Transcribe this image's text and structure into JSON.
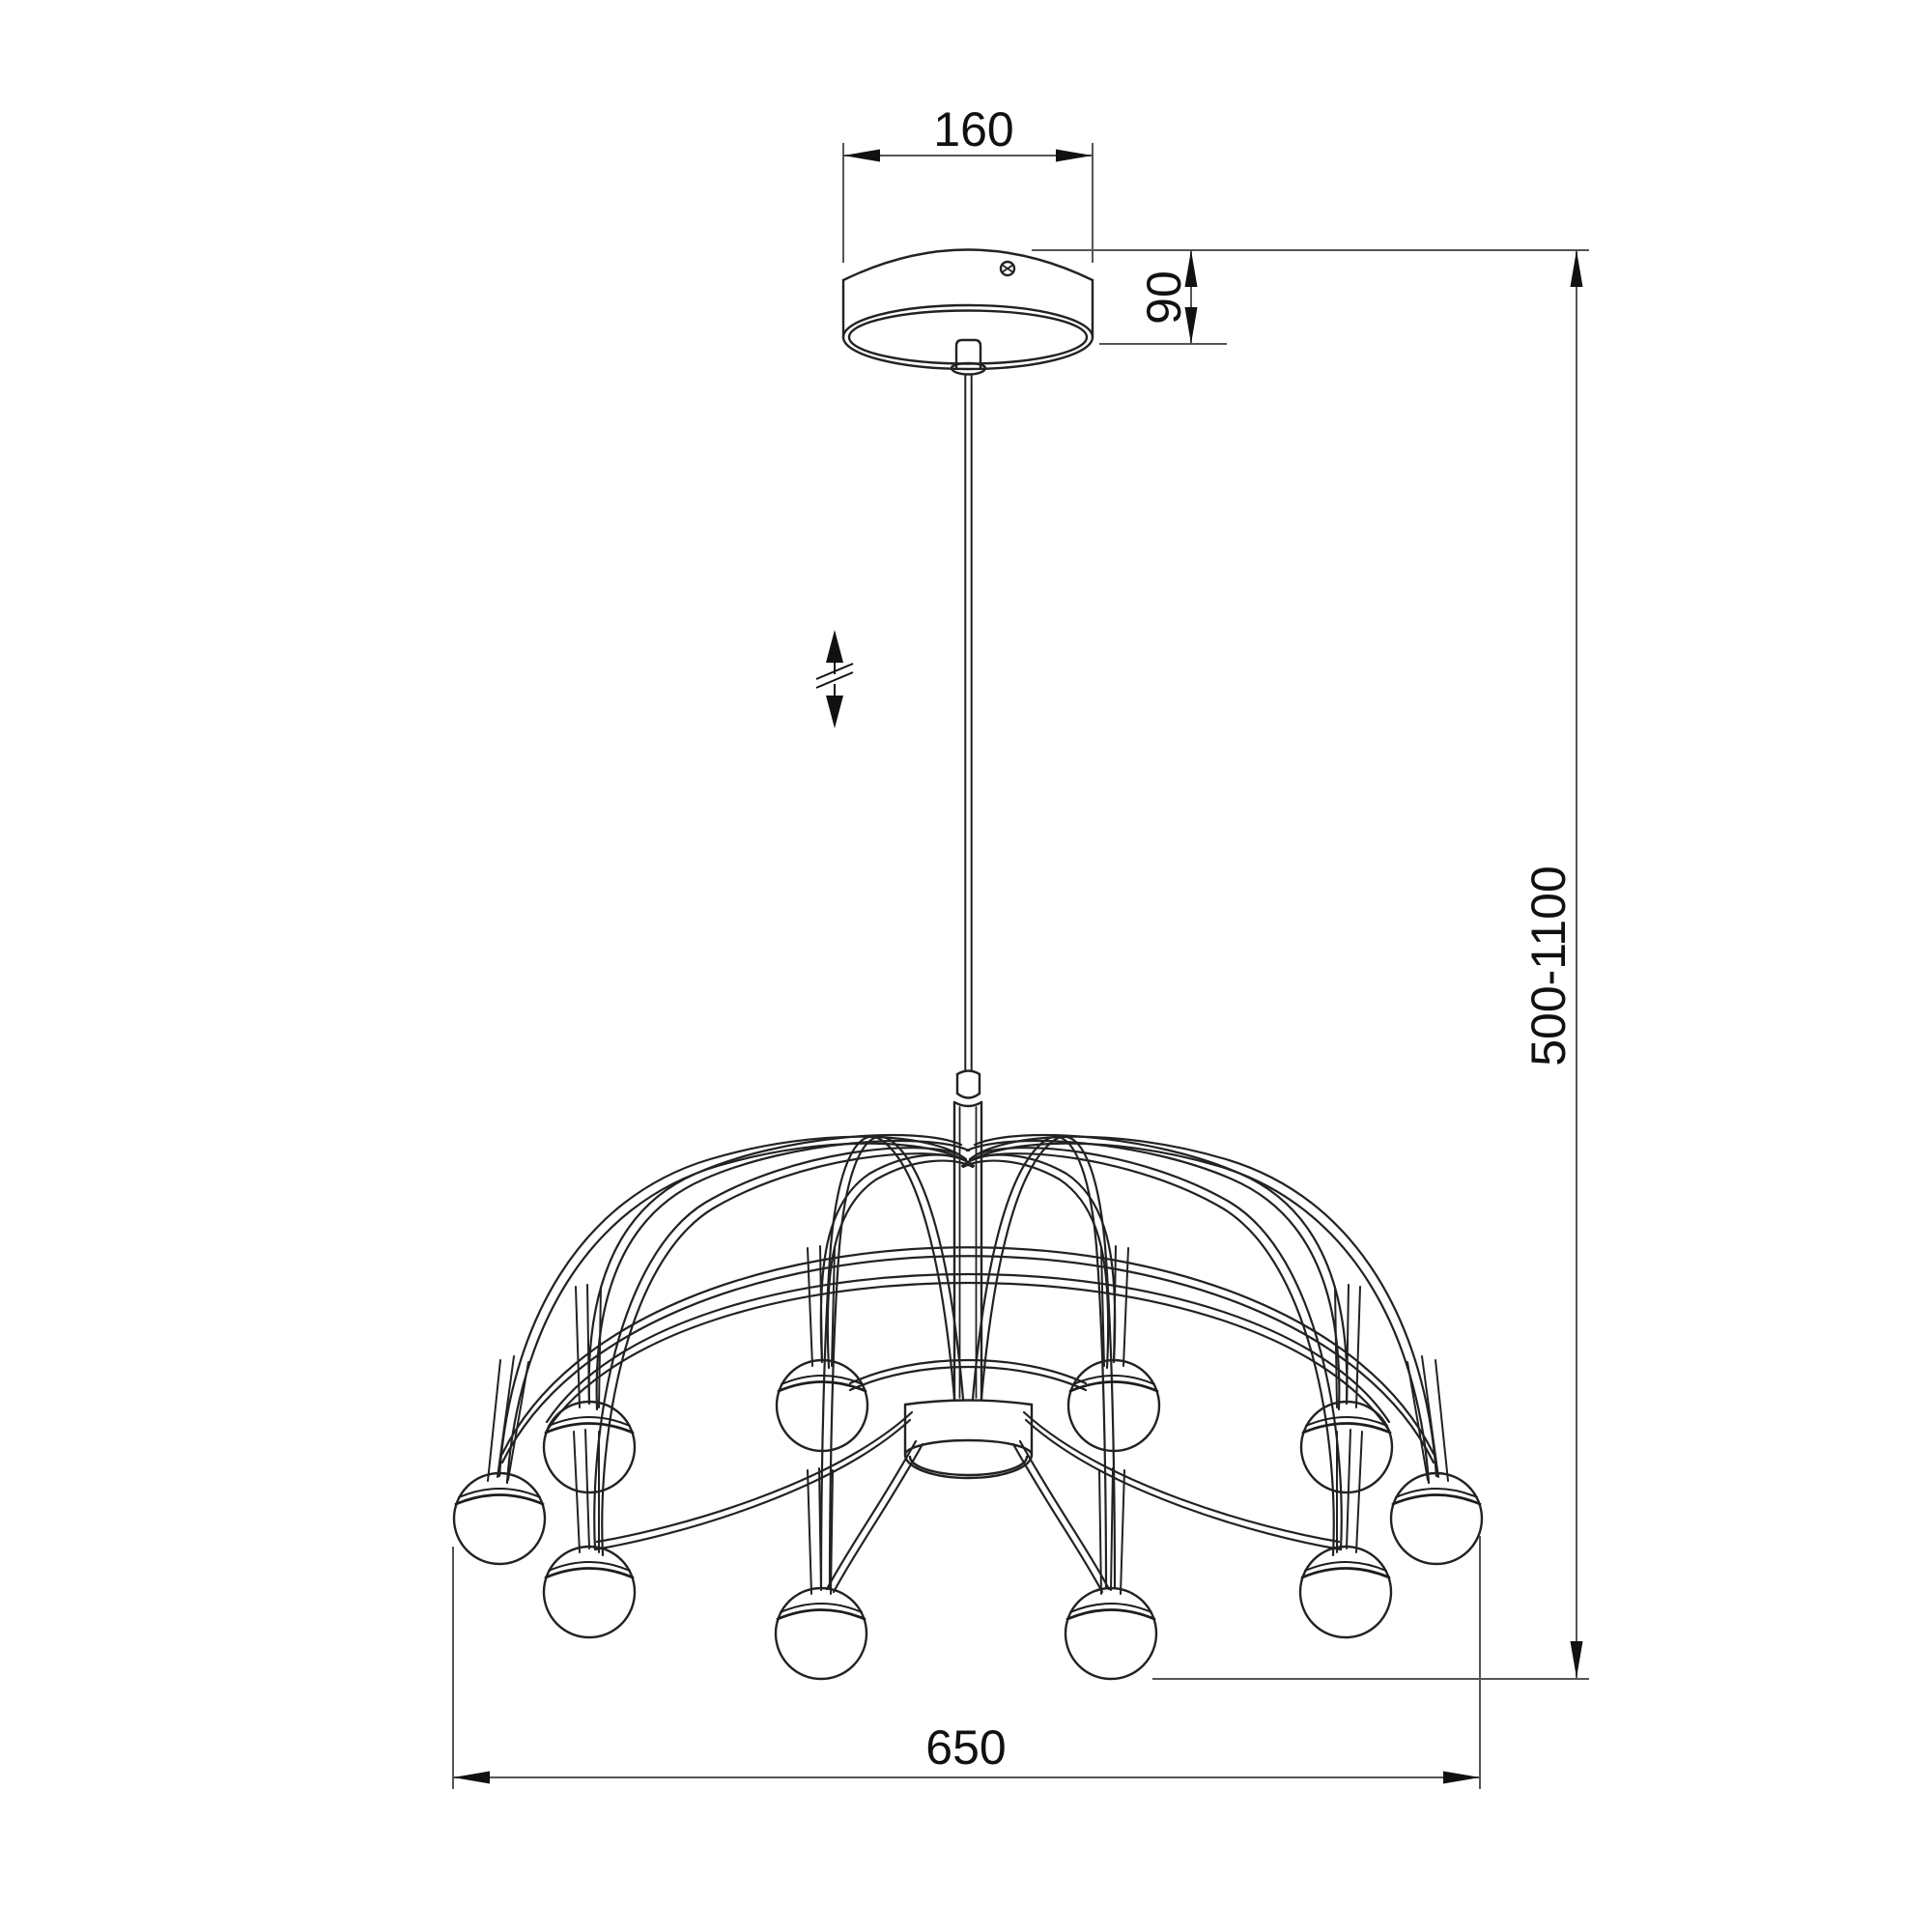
{
  "meta": {
    "title": "Pendant chandelier dimensional drawing",
    "background": "#ffffff"
  },
  "dimensions": {
    "canopy_width_mm": "160",
    "canopy_height_mm": "90",
    "suspension_range_mm": "500-1100",
    "fixture_diameter_mm": "650"
  },
  "annotations": {
    "height_adjustable_symbol": "double-headed vertical arrow with break mark (adjustable suspension length)"
  },
  "style": {
    "line_color": "#222222",
    "dimension_line_color": "#555555",
    "text_color": "#111111"
  }
}
